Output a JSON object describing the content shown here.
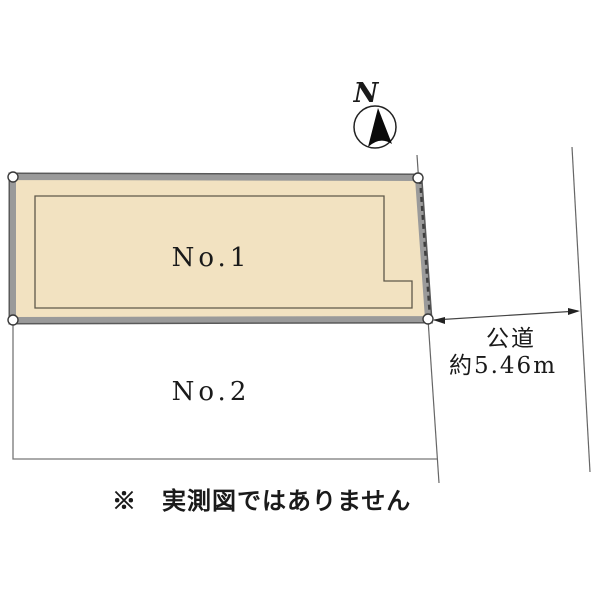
{
  "compass": {
    "north_label": "N"
  },
  "parcels": {
    "no1": {
      "label": "No.1",
      "fill_color": "#F2E2C1"
    },
    "no2": {
      "label": "No.2"
    }
  },
  "road": {
    "name_label": "公道",
    "width_label": "約5.46m"
  },
  "note_label": "※　実測図ではありません",
  "colors": {
    "parcel_border_gray": "#8E8E8E",
    "parcel_border_edge": "#5A5A5A",
    "building_outline": "#5F584A",
    "boundary_line": "#666666",
    "hatch_dash": "#3F3F3F",
    "text": "#1A1A1A"
  }
}
